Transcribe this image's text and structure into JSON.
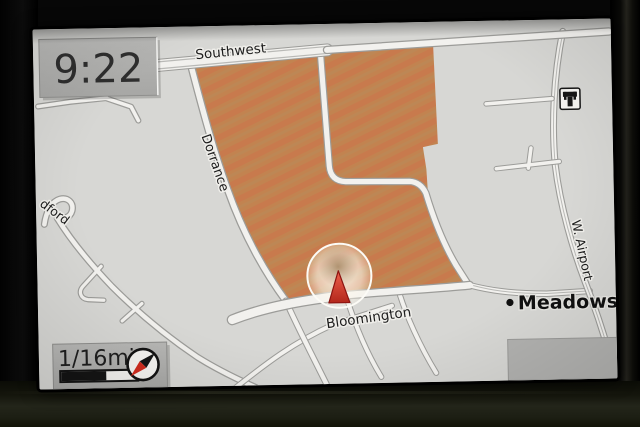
{
  "device": {
    "kind": "in-dash navigation display",
    "bezel_color": "#0b0c06"
  },
  "clock": {
    "time": "9:22"
  },
  "scale": {
    "label": "1/16mi",
    "bar_fill_ratio": 0.58
  },
  "compass": {
    "icon": "compass-needle-icon",
    "needle_ne_color": "#161616",
    "needle_sw_color": "#cf2b1d"
  },
  "map": {
    "background_color": "#d7d7d4",
    "area_fill_color": "#c28350",
    "road_fill_color": "#f2f1ee",
    "road_casing_color": "#9c9c99",
    "streets": {
      "southwest": "Southwest",
      "dorrance": "Dorrance",
      "bloomington": "Bloomington",
      "w_airport": "W. Airport",
      "dford_partial": "dford"
    },
    "poi": {
      "meadows_label": "Meadows P",
      "marker": "poi-dot"
    },
    "icons": {
      "station": "rail-station-icon",
      "vehicle": "vehicle-position-triangle-icon"
    },
    "vehicle_marker_color": "#d5372a"
  }
}
